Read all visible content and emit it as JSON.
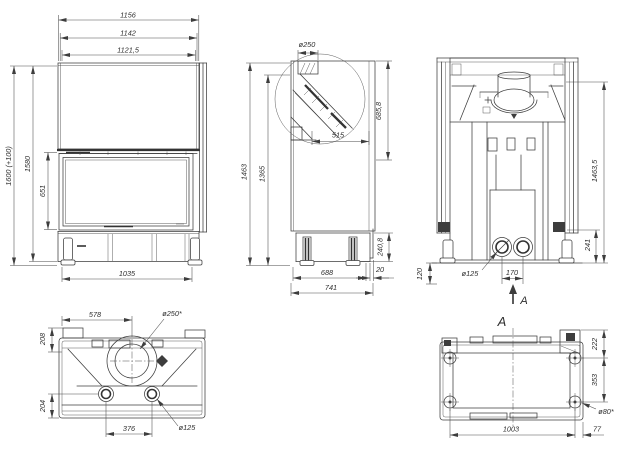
{
  "drawing": {
    "colors": {
      "line": "#3d3d3d",
      "dim": "#4a4a4a",
      "text": "#2f2f2f",
      "background": "#ffffff"
    },
    "front": {
      "w1": "1156",
      "w2": "1142",
      "w3": "1121,5",
      "h1": "1600 (+100)",
      "h2": "1580",
      "h3": "651",
      "base_w": "1035"
    },
    "side": {
      "flue_d": "ø250",
      "hood_h": "685,8",
      "depth_in": "515",
      "h1": "1463",
      "h2": "1365",
      "base_h": "240,8",
      "lip": "20",
      "base_d": "688",
      "total_d": "741"
    },
    "rear": {
      "h": "1463,5",
      "leg_h": "241",
      "outlet_d": "ø125",
      "spacing": "170",
      "off": "120",
      "section": "A"
    },
    "top": {
      "w": "578",
      "flue_d": "ø250*",
      "d1": "208",
      "d2": "204",
      "spacing": "376",
      "outlet_d": "ø125"
    },
    "bottom": {
      "label": "A",
      "d1": "222",
      "d2": "353",
      "hole_d": "ø80*",
      "w": "1003",
      "off": "77"
    }
  }
}
